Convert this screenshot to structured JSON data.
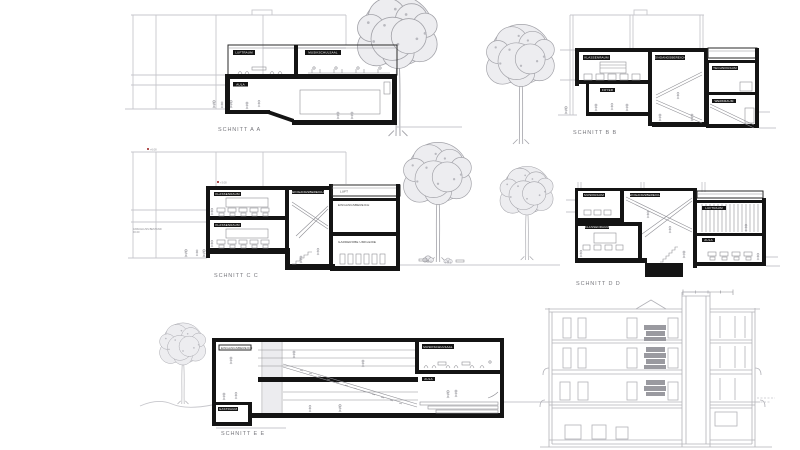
{
  "sections": {
    "a": {
      "label": "SCHNITT A A",
      "rooms": {
        "r1": "LUFTRAUM",
        "r2": "MUSIKSCHULSAAL",
        "r3": "AULA"
      }
    },
    "b": {
      "label": "SCHNITT B B",
      "rooms": {
        "r1": "KLASSENRAUM",
        "r2": "FOYER",
        "r3": "EINGANGSBEREICH",
        "r4": "TECHNIKRAUM",
        "r5": "WERKRAUM"
      }
    },
    "c": {
      "label": "SCHNITT C C",
      "rooms": {
        "r1": "KLASSENRAUM",
        "r2": "KLASSENRAUM",
        "r3": "EINGANGSBEREICH",
        "r4": "LUFT",
        "r5": "EINGANGSBEREICH",
        "r6": "GARDEROBE UMKLEIDE"
      },
      "ann": {
        "level_roof": "+6.08",
        "level_mid": "+3.08",
        "note1": "ANSCHLUSS BESTAND",
        "note2": "±0.00"
      }
    },
    "d": {
      "label": "SCHNITT D D",
      "rooms": {
        "r1": "MUSIKRAUM",
        "r2": "EINGANGSBEREICH",
        "r3": "KLASSENRAUM",
        "r4": "LUFTRAUM",
        "r5": "AULA"
      }
    },
    "e": {
      "label": "SCHNITT E E",
      "rooms": {
        "r1": "EINGANGSBEREICH",
        "r2": "MUSIKSCHULSAAL",
        "r3": "AULA",
        "r4": "GASTRAUM"
      }
    }
  },
  "colors": {
    "ink": "#141414",
    "background_building": "#c7c7cc",
    "existing_elevation": "#b2b2b8",
    "tree": "#a3a3a9",
    "label": "#77777d",
    "paper": "#ffffff"
  }
}
